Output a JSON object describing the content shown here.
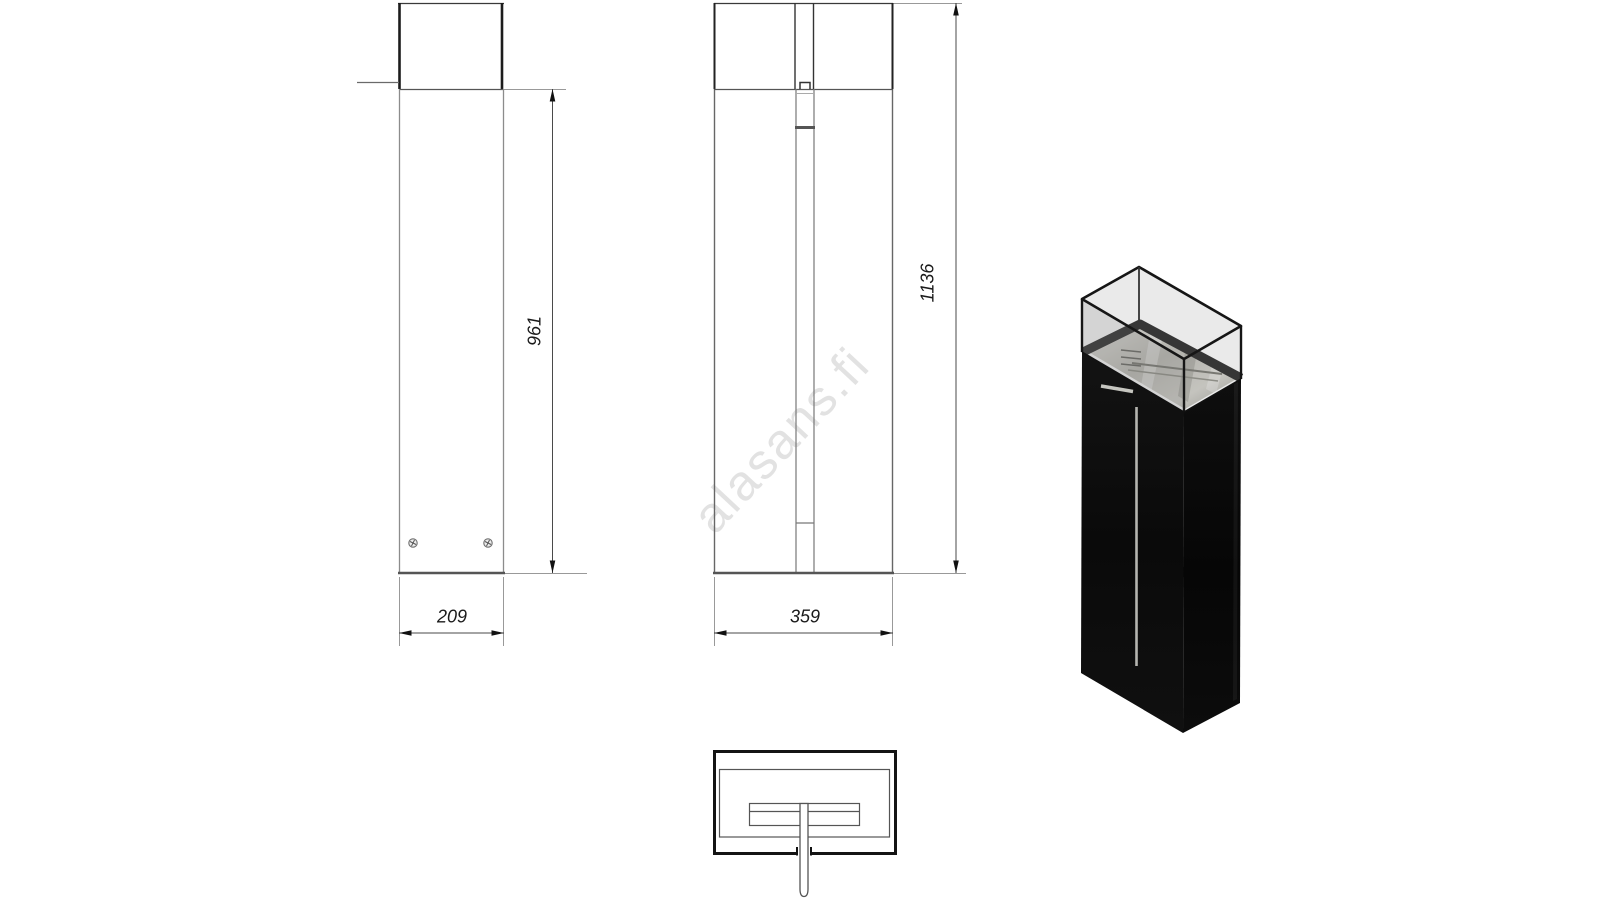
{
  "watermark": "alasans.fi",
  "views": {
    "side": {
      "width_dim": "209",
      "height_dim": "961"
    },
    "front": {
      "width_dim": "359",
      "height_dim": "1136"
    }
  },
  "colors": {
    "background": "#ffffff",
    "outline_dark": "#1c1c1c",
    "outline_medium": "#555555",
    "extension_line": "#999999",
    "dim_text": "#1a1a1a",
    "watermark_gray": "#e2e2e2",
    "body_black": "#0b0b0b",
    "glass_tint": "#d8d8d8",
    "steel_light": "#d6d5cf",
    "steel_dark": "#9a9a93",
    "pipe_silver": "#b5b5b0"
  }
}
